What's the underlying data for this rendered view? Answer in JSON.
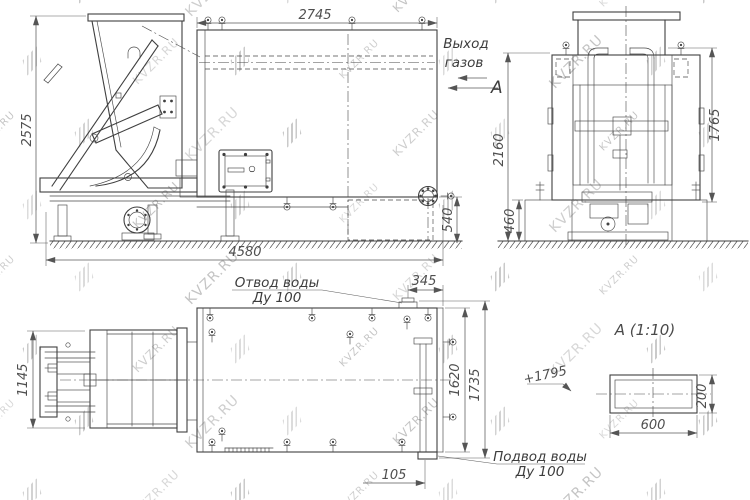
{
  "watermark": {
    "text": "KVZR.RU"
  },
  "front_view": {
    "dim_top": "2745",
    "dim_left": "2575",
    "dim_bottom": "4580",
    "dim_right": "540",
    "gas_outlet_l1": "Выход",
    "gas_outlet_l2": "газов",
    "section_letter": "А"
  },
  "side_view": {
    "dim_left": "2160",
    "dim_right": "1765",
    "dim_foundation": "460"
  },
  "plan_view": {
    "dim_left": "1145",
    "dim_offset_top": "345",
    "dim_inner_width": "1620",
    "dim_outer_width": "1735",
    "dim_offset_bottom": "105",
    "outlet_l1": "Отвод воды",
    "outlet_l2": "Ду 100",
    "inlet_l1": "Подвод воды",
    "inlet_l2": "Ду 100"
  },
  "detail_view": {
    "title": "А  (1:10)",
    "dim_width": "600",
    "dim_height": "200",
    "elevation": "+1795"
  }
}
